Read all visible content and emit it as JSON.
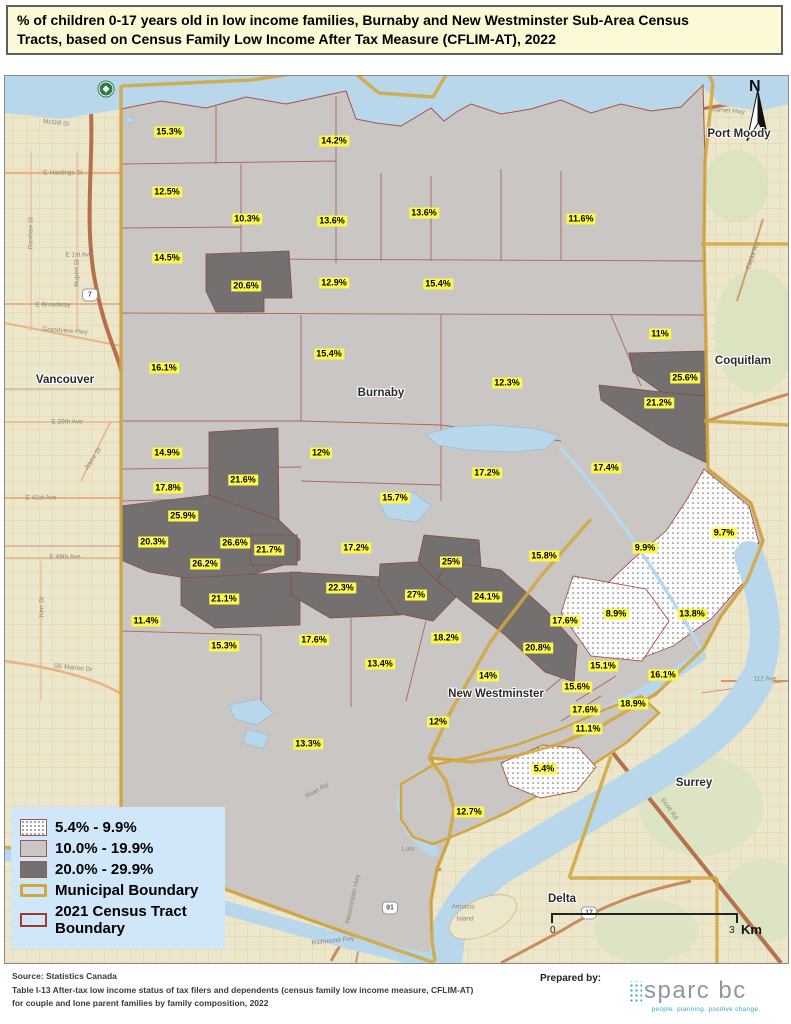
{
  "title": {
    "line1": "% of children 0-17 years old in low income families, Burnaby and New Westminster Sub-Area Census",
    "line2": "Tracts, based on Census Family Low Income After Tax Measure (CFLIM-AT), 2022"
  },
  "map": {
    "tract_labels": [
      {
        "v": "15.3%",
        "x": 168,
        "y": 131
      },
      {
        "v": "14.2%",
        "x": 333,
        "y": 140
      },
      {
        "v": "11.6%",
        "x": 580,
        "y": 218
      },
      {
        "v": "12.5%",
        "x": 166,
        "y": 191
      },
      {
        "v": "10.3%",
        "x": 246,
        "y": 218
      },
      {
        "v": "13.6%",
        "x": 331,
        "y": 220
      },
      {
        "v": "13.6%",
        "x": 423,
        "y": 212
      },
      {
        "v": "14.5%",
        "x": 166,
        "y": 257
      },
      {
        "v": "20.6%",
        "x": 245,
        "y": 285
      },
      {
        "v": "12.9%",
        "x": 333,
        "y": 282
      },
      {
        "v": "15.4%",
        "x": 437,
        "y": 283
      },
      {
        "v": "11%",
        "x": 659,
        "y": 333
      },
      {
        "v": "16.1%",
        "x": 163,
        "y": 367
      },
      {
        "v": "15.4%",
        "x": 328,
        "y": 353
      },
      {
        "v": "12.3%",
        "x": 506,
        "y": 382
      },
      {
        "v": "25.6%",
        "x": 684,
        "y": 377
      },
      {
        "v": "21.2%",
        "x": 658,
        "y": 402
      },
      {
        "v": "14.9%",
        "x": 166,
        "y": 452
      },
      {
        "v": "21.6%",
        "x": 242,
        "y": 479
      },
      {
        "v": "12%",
        "x": 320,
        "y": 452
      },
      {
        "v": "17.2%",
        "x": 486,
        "y": 472
      },
      {
        "v": "17.4%",
        "x": 605,
        "y": 467
      },
      {
        "v": "17.8%",
        "x": 167,
        "y": 487
      },
      {
        "v": "15.7%",
        "x": 394,
        "y": 497
      },
      {
        "v": "25.9%",
        "x": 182,
        "y": 515
      },
      {
        "v": "20.3%",
        "x": 152,
        "y": 541
      },
      {
        "v": "26.6%",
        "x": 234,
        "y": 542
      },
      {
        "v": "21.7%",
        "x": 268,
        "y": 549
      },
      {
        "v": "26.2%",
        "x": 204,
        "y": 563
      },
      {
        "v": "17.2%",
        "x": 355,
        "y": 547
      },
      {
        "v": "25%",
        "x": 450,
        "y": 561
      },
      {
        "v": "15.8%",
        "x": 543,
        "y": 555
      },
      {
        "v": "9.9%",
        "x": 644,
        "y": 547
      },
      {
        "v": "9.7%",
        "x": 723,
        "y": 532
      },
      {
        "v": "22.3%",
        "x": 340,
        "y": 587
      },
      {
        "v": "27%",
        "x": 415,
        "y": 594
      },
      {
        "v": "24.1%",
        "x": 486,
        "y": 596
      },
      {
        "v": "8.9%",
        "x": 615,
        "y": 613
      },
      {
        "v": "13.8%",
        "x": 691,
        "y": 613
      },
      {
        "v": "21.1%",
        "x": 223,
        "y": 598
      },
      {
        "v": "11.4%",
        "x": 145,
        "y": 620
      },
      {
        "v": "17.6%",
        "x": 564,
        "y": 620
      },
      {
        "v": "15.3%",
        "x": 223,
        "y": 645
      },
      {
        "v": "17.6%",
        "x": 313,
        "y": 639
      },
      {
        "v": "18.2%",
        "x": 445,
        "y": 637
      },
      {
        "v": "13.4%",
        "x": 379,
        "y": 663
      },
      {
        "v": "20.8%",
        "x": 537,
        "y": 647
      },
      {
        "v": "15.1%",
        "x": 602,
        "y": 665
      },
      {
        "v": "16.1%",
        "x": 662,
        "y": 674
      },
      {
        "v": "14%",
        "x": 487,
        "y": 675
      },
      {
        "v": "15.6%",
        "x": 576,
        "y": 686
      },
      {
        "v": "17.6%",
        "x": 584,
        "y": 709
      },
      {
        "v": "18.9%",
        "x": 632,
        "y": 703
      },
      {
        "v": "12%",
        "x": 437,
        "y": 721
      },
      {
        "v": "11.1%",
        "x": 587,
        "y": 728
      },
      {
        "v": "13.3%",
        "x": 307,
        "y": 743
      },
      {
        "v": "5.4%",
        "x": 543,
        "y": 768
      },
      {
        "v": "12.7%",
        "x": 468,
        "y": 811
      }
    ],
    "place_labels": [
      {
        "v": "Vancouver",
        "x": 64,
        "y": 379
      },
      {
        "v": "Port Moody",
        "x": 738,
        "y": 133
      },
      {
        "v": "Coquitlam",
        "x": 742,
        "y": 360
      },
      {
        "v": "Burnaby",
        "x": 380,
        "y": 392
      },
      {
        "v": "New Westminster",
        "x": 495,
        "y": 693
      },
      {
        "v": "Surrey",
        "x": 693,
        "y": 782
      },
      {
        "v": "Delta",
        "x": 561,
        "y": 898
      }
    ],
    "street_labels": [
      {
        "v": "McGill St",
        "x": 55,
        "y": 122,
        "r": 6
      },
      {
        "v": "E Hastings St",
        "x": 62,
        "y": 172,
        "r": 0
      },
      {
        "v": "Renfrew St",
        "x": 30,
        "y": 232,
        "r": -90
      },
      {
        "v": "Rupert St",
        "x": 76,
        "y": 272,
        "r": -90
      },
      {
        "v": "E 1st Ave",
        "x": 78,
        "y": 254,
        "r": 0
      },
      {
        "v": "E Broadway",
        "x": 52,
        "y": 304,
        "r": 0
      },
      {
        "v": "Grandview Hwy",
        "x": 64,
        "y": 330,
        "r": 4
      },
      {
        "v": "E 29th Ave",
        "x": 66,
        "y": 421,
        "r": 0
      },
      {
        "v": "Joyce St",
        "x": 92,
        "y": 458,
        "r": -55
      },
      {
        "v": "E 41st Ave",
        "x": 40,
        "y": 497,
        "r": 0
      },
      {
        "v": "E 49th Ave",
        "x": 64,
        "y": 556,
        "r": 0
      },
      {
        "v": "Kerr St",
        "x": 41,
        "y": 606,
        "r": -90
      },
      {
        "v": "SE Marine Dr",
        "x": 72,
        "y": 667,
        "r": 6
      },
      {
        "v": "Barnet Hwy",
        "x": 727,
        "y": 110,
        "r": 5
      },
      {
        "v": "Clarke Rd",
        "x": 752,
        "y": 255,
        "r": -70
      },
      {
        "v": "112 Ave",
        "x": 764,
        "y": 678,
        "r": 0
      },
      {
        "v": "Scott Rd",
        "x": 668,
        "y": 808,
        "r": 55
      },
      {
        "v": "Westminster Hwy",
        "x": 352,
        "y": 898,
        "r": -78
      },
      {
        "v": "Richmond Fwy",
        "x": 332,
        "y": 940,
        "r": -6
      },
      {
        "v": "River Rd",
        "x": 316,
        "y": 790,
        "r": -28
      },
      {
        "v": "Lulu",
        "x": 407,
        "y": 848,
        "r": 0
      },
      {
        "v": "Annacis",
        "x": 462,
        "y": 906,
        "r": 0
      },
      {
        "v": "Island",
        "x": 464,
        "y": 918,
        "r": 0
      }
    ],
    "route_shields": [
      {
        "v": "",
        "x": 105,
        "y": 88,
        "tc": true
      },
      {
        "v": "7",
        "x": 89,
        "y": 294
      },
      {
        "v": "91",
        "x": 389,
        "y": 907
      },
      {
        "v": "17",
        "x": 588,
        "y": 912
      }
    ],
    "north": {
      "label": "N"
    },
    "scale_bar": {
      "zero": "0",
      "max": "3",
      "unit": "Km"
    }
  },
  "legend": {
    "items": [
      {
        "label": "5.4% - 9.9%",
        "swatch": "dotted"
      },
      {
        "label": "10.0% - 19.9%",
        "swatch": "light"
      },
      {
        "label": "20.0% - 29.9%",
        "swatch": "dark"
      },
      {
        "label": "Municipal Boundary",
        "swatch": "municipal"
      },
      {
        "label": "2021 Census Tract Boundary",
        "swatch": "tract"
      }
    ]
  },
  "footer": {
    "source_lines": [
      "Source: Statistics Canada",
      "Table I-13 After-tax low income status of tax filers and dependents (census family low income measure, CFLIM-AT)",
      "for couple and lone parent families by family composition, 2022"
    ],
    "prepared_by": "Prepared by:",
    "logo": {
      "name": "sparc bc",
      "tagline": "people. planning. positive change."
    }
  },
  "colors": {
    "low_dotted": "#ffffff",
    "mid_gray": "#c9c6c3",
    "high_gray": "#757070",
    "municipal_boundary": "#d2a73e",
    "tract_boundary": "#a8524a",
    "water": "#b9d7eb",
    "tract_label_bg": "#fcf84e",
    "legend_bg": "#cfe7f8",
    "title_bg": "#fcfad6",
    "logo_teal": "#2fa8c5"
  }
}
